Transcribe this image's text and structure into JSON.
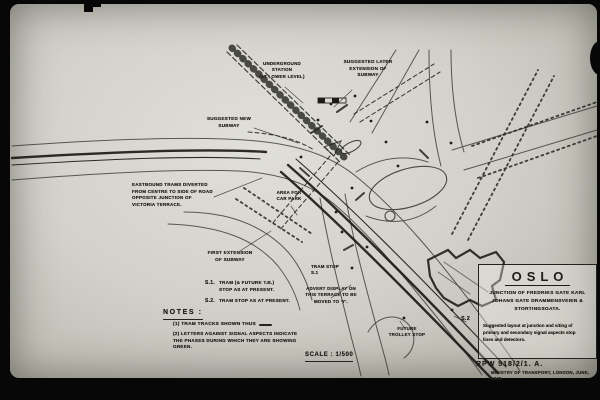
{
  "photo": {
    "colors": {
      "film_black": "#070707",
      "paper": "#d2d1ca",
      "ink": "#23221c"
    }
  },
  "plan": {
    "annotations": {
      "underground_station": "UNDERGROUND\nSTATION\n(AT LOWER LEVEL)",
      "suggested_later_extension": "SUGGESTED LATER\nEXTENSION OF\nSUBWAY",
      "suggested_new_subway": "SUGGESTED NEW\nSUBWAY",
      "eastbound_trams": "EASTBOUND TRAMS DIVERTED\nFROM CENTRE TO SIDE OF ROAD\nOPPOSITE JUNCTION OF\nVICTORIA TERRACE.",
      "area_for_car_park": "AREA FOR\nCAR PARK",
      "first_extension": "FIRST EXTENSION\nOF SUBWAY",
      "tram_stop_s1": "TRAM STOP\nS.1",
      "advert_display": "ADVERT DISPLAY ON\nTHIS TERRACE TO BE\nMOVED TO 'Y'.",
      "future_trolley_stop": "FUTURE\nTROLLEY STOP",
      "s2_marker": "S.2"
    },
    "legend": {
      "s1_key": "S.1.",
      "s1_text": "TRAM (& FUTURE T.B.)\nSTOP AS AT PRESENT.",
      "s2_key": "S.2.",
      "s2_text": "TRAM STOP AS AT PRESENT."
    },
    "notes": {
      "heading": "NOTES :",
      "note1": "(1)  TRAM TRACKS SHOWN THUS",
      "note2": "(2)  LETTERS AGAINST SIGNAL ASPECTS INDICATE\nTHE PHASES DURING WHICH THEY ARE SHOWING GREEN."
    },
    "scale_label": "SCALE : 1/500",
    "title_block": {
      "city": "OSLO",
      "junction": "JUNCTION OF FREDRIKS GATE KARL\nJOHANS GATE DRAMMENSVEIEN &\nSTORTINGSGATA.",
      "description": "Suggested layout at junction and siting of\nprimary and secondary signal aspects stop\nlines and detectors.",
      "drawing_number": "RPW 518/2/1. A.",
      "ministry": "MINISTRY OF TRANSPORT, LONDON, JUNE, 1949."
    }
  }
}
